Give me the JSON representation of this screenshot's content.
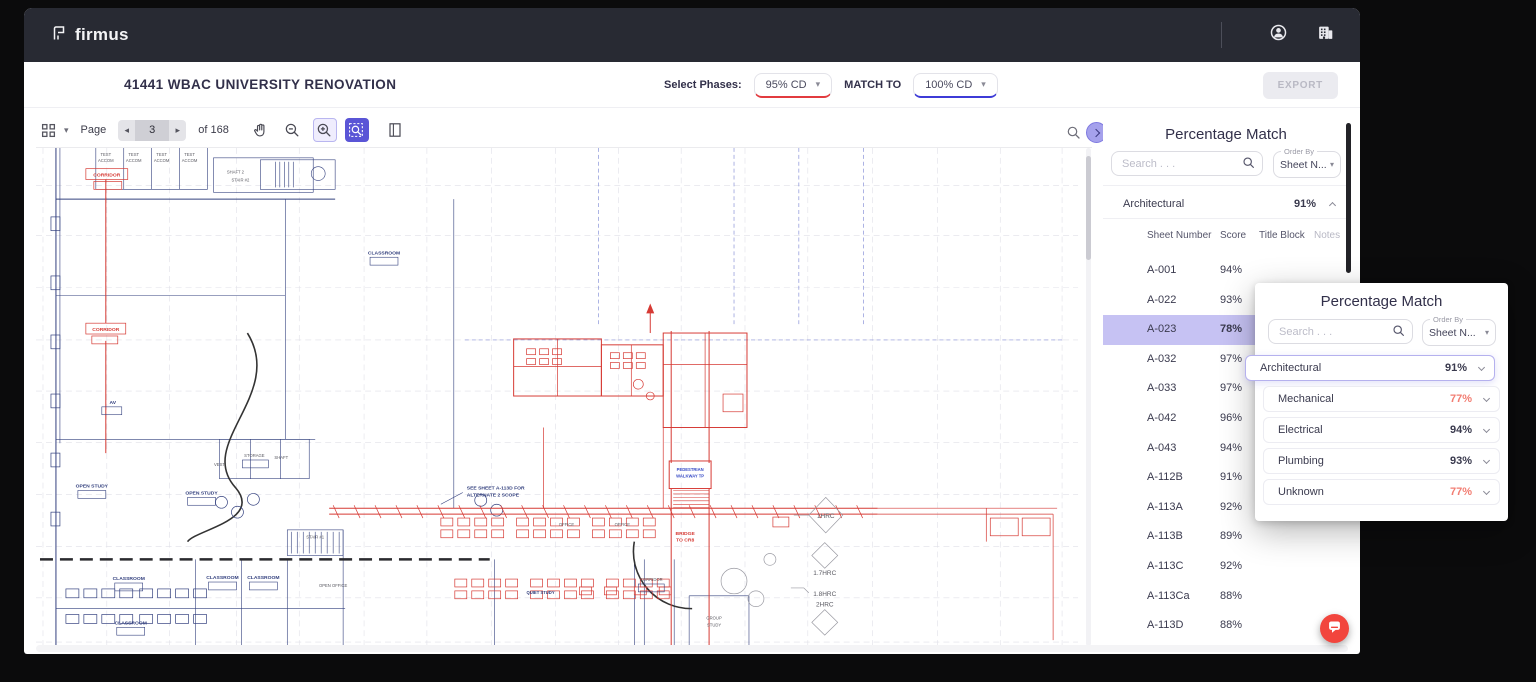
{
  "navbar": {
    "brand": "firmus"
  },
  "header": {
    "title": "41441 WBAC UNIVERSITY RENOVATION",
    "select_phases_label": "Select Phases:",
    "phase_from": "95% CD",
    "match_to_label": "MATCH TO",
    "phase_to": "100% CD",
    "export_label": "EXPORT"
  },
  "pdf_toolbar": {
    "page_label": "Page",
    "page_value": "3",
    "of_label": "of 168"
  },
  "icons": {
    "caret_down": "▾",
    "prev": "◂",
    "next": "▸"
  },
  "sidebar": {
    "title": "Percentage Match",
    "search_placeholder": "Search . . .",
    "order_by_label": "Order By",
    "order_by_value": "Sheet N...",
    "category": {
      "name": "Architectural",
      "score": "91%"
    },
    "columns": {
      "sheet": "Sheet Number",
      "score": "Score",
      "title_block": "Title Block",
      "notes": "Notes"
    },
    "rows": [
      {
        "sheet": "A-001",
        "score": "94%"
      },
      {
        "sheet": "A-022",
        "score": "93%"
      },
      {
        "sheet": "A-023",
        "score": "78%"
      },
      {
        "sheet": "A-032",
        "score": "97%"
      },
      {
        "sheet": "A-033",
        "score": "97%"
      },
      {
        "sheet": "A-042",
        "score": "96%"
      },
      {
        "sheet": "A-043",
        "score": "94%"
      },
      {
        "sheet": "A-112B",
        "score": "91%"
      },
      {
        "sheet": "A-113A",
        "score": "92%"
      },
      {
        "sheet": "A-113B",
        "score": "89%"
      },
      {
        "sheet": "A-113C",
        "score": "92%"
      },
      {
        "sheet": "A-113Ca",
        "score": "88%"
      },
      {
        "sheet": "A-113D",
        "score": "88%"
      }
    ]
  },
  "popup": {
    "title": "Percentage Match",
    "search_placeholder": "Search . . .",
    "order_by_label": "Order By",
    "order_by_value": "Sheet N...",
    "categories": [
      {
        "name": "Architectural",
        "score": "91%"
      },
      {
        "name": "Mechanical",
        "score": "77%"
      },
      {
        "name": "Electrical",
        "score": "94%"
      },
      {
        "name": "Plumbing",
        "score": "93%"
      },
      {
        "name": "Unknown",
        "score": "77%"
      }
    ]
  },
  "drawing": {
    "test": "TEST",
    "accom": "ACCOM",
    "corridor": "CORRIDOR",
    "shaft2": "SHAFT 2",
    "stair2": "STAIR #2",
    "classroom": "CLASSROOM",
    "av": "AV",
    "open_study": "OPEN STUDY",
    "storage": "STORAGE",
    "vest": "VEST",
    "shaft": "SHAFT",
    "stair1": "STAIR #1",
    "open_office": "OPEN OFFICE",
    "office": "OFFICE",
    "quiet_study": "QUIET STUDY",
    "group_1": "GROUP",
    "group_2": "STUDY",
    "bridge_1": "BRIDGE",
    "bridge_2": "TO CR8",
    "ped_1": "PEDESTRIAN",
    "ped_2": "WALKWAY TP",
    "alt_1": "SEE SHEET A-113D FOR",
    "alt_2": "ALTERNATE 2 SCOPE",
    "hrc1": "1HRC",
    "hrc17": "1.7HRC",
    "hrc18": "1.8HRC",
    "hrc2": "2HRC"
  },
  "colors": {
    "navbar_bg": "#282a33",
    "accent_red": "#e23b3f",
    "accent_blue": "#3d3bd7",
    "accent_purple": "#5a55d6",
    "row_highlight": "#c6c2f3",
    "low_score": "#f27d72",
    "chat_button": "#f2453d",
    "plan_red": "#d63a34",
    "plan_navy": "#33407e"
  }
}
